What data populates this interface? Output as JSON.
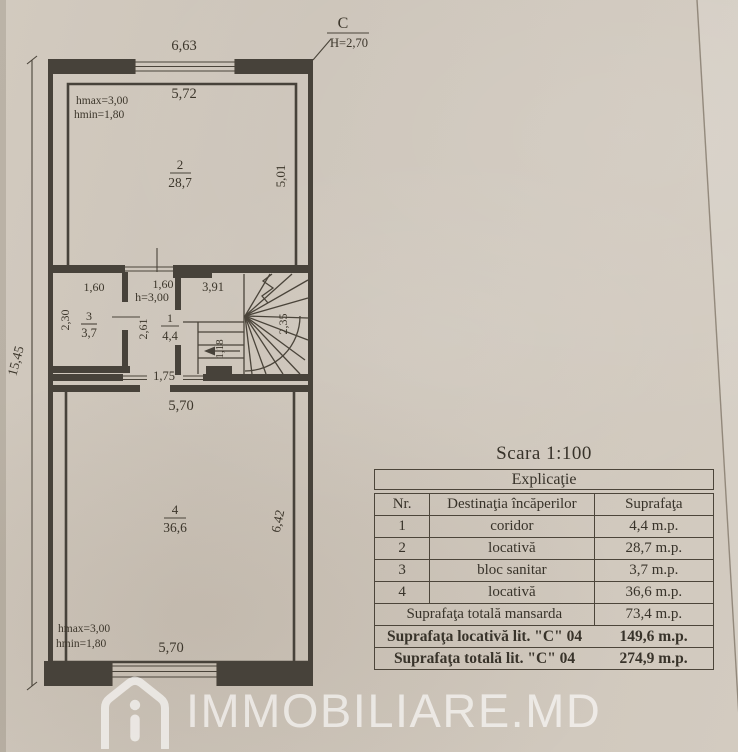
{
  "plan": {
    "north_letter": "C",
    "north_height": "H=2,70",
    "dim_top": "6,63",
    "dim_left": "15,45",
    "room2": {
      "hmax": "hmax=3,00",
      "hmin": "hmin=1,80",
      "width": "5,72",
      "num": "2",
      "area": "28,7",
      "height": "5,01"
    },
    "room3": {
      "width": "1,60",
      "height": "2,30",
      "num": "3",
      "area": "3,7"
    },
    "corridor": {
      "width": "1,60",
      "hnote": "h=3,00",
      "height": "2,61",
      "num": "1",
      "area": "4,4",
      "opening": "1,75"
    },
    "stairs": {
      "width": "3,91",
      "flight": "1,18",
      "height": "2,35"
    },
    "room4": {
      "width_top": "5,70",
      "num": "4",
      "area": "36,6",
      "height": "6,42",
      "hmax": "hmax=3,00",
      "hmin": "hmin=1,80",
      "width_bottom": "5,70"
    }
  },
  "scale_label": "Scara 1:100",
  "table": {
    "title": "Explicaţie",
    "columns": [
      "Nr.",
      "Destinaţia încăperilor",
      "Suprafaţa"
    ],
    "rows": [
      {
        "nr": "1",
        "dest": "coridor",
        "area": "4,4 m.p."
      },
      {
        "nr": "2",
        "dest": "locativă",
        "area": "28,7 m.p."
      },
      {
        "nr": "3",
        "dest": "bloc sanitar",
        "area": "3,7 m.p."
      },
      {
        "nr": "4",
        "dest": "locativă",
        "area": "36,6 m.p."
      }
    ],
    "summary": [
      {
        "label": "Suprafaţa totală mansarda",
        "area": "73,4 m.p."
      },
      {
        "label": "Suprafaţa locativă lit. \"C\" 04",
        "area": "149,6 m.p."
      },
      {
        "label": "Suprafaţa totală lit. \"C\" 04",
        "area": "274,9 m.p."
      }
    ]
  },
  "watermark": {
    "text": "IMMOBILIARE.MD"
  }
}
